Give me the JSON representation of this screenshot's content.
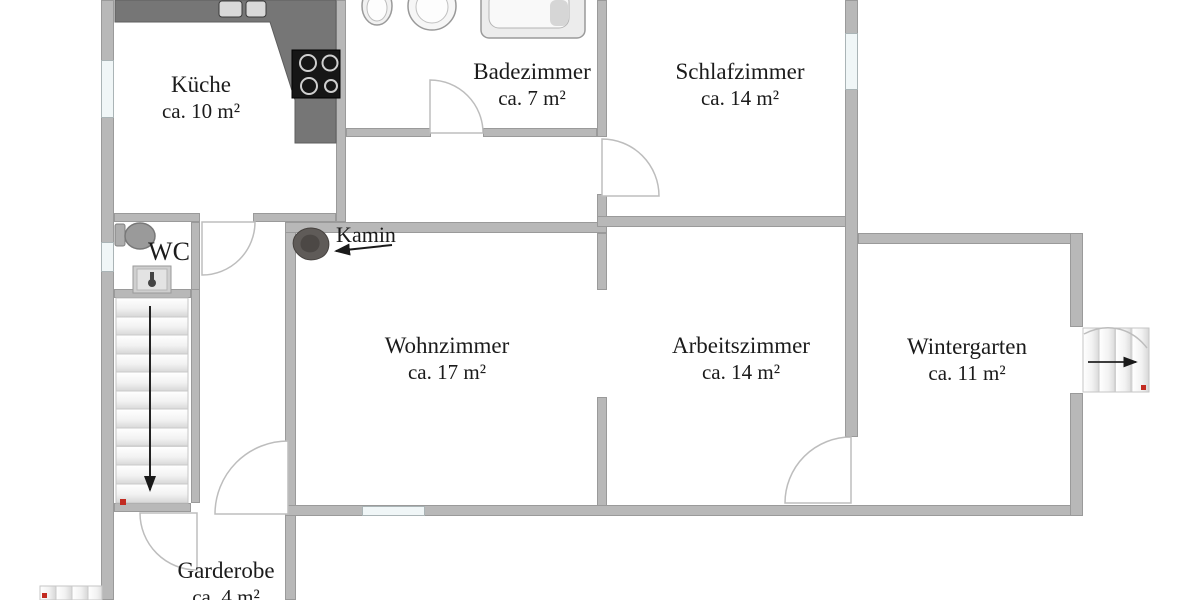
{
  "rooms": {
    "kueche": {
      "name": "Küche",
      "area": "ca. 10 m²"
    },
    "badezimmer": {
      "name": "Badezimmer",
      "area": "ca. 7 m²"
    },
    "schlafzimmer": {
      "name": "Schlafzimmer",
      "area": "ca. 14 m²"
    },
    "wc": {
      "name": "WC"
    },
    "wohnzimmer": {
      "name": "Wohnzimmer",
      "area": "ca. 17 m²"
    },
    "arbeitszimmer": {
      "name": "Arbeitszimmer",
      "area": "ca. 14 m²"
    },
    "wintergarten": {
      "name": "Wintergarten",
      "area": "ca. 11 m²"
    },
    "garderobe": {
      "name": "Garderobe",
      "area": "ca. 4 m²"
    }
  },
  "annotations": {
    "kamin_label": "Kamin"
  },
  "icons": {
    "kamin": "fireplace-blob",
    "kamin_arrow": "arrow-left",
    "main_stairs_arrow": "arrow-down",
    "exit_stairs_arrow": "arrow-right",
    "fixtures": [
      "kitchen-sink",
      "stove",
      "bathtub",
      "toilet",
      "washbasin"
    ]
  },
  "colors": {
    "background": "#ffffff",
    "wall": "#b8b8b8",
    "wall_edge": "#9a9a9a",
    "window": "#f0f6f7",
    "counter": "#767676",
    "stove": "#161616",
    "kamin": "#5f5b58",
    "door": "#bdbdbd",
    "text": "#1b1b1b",
    "stair_dot": "#c22b21"
  }
}
